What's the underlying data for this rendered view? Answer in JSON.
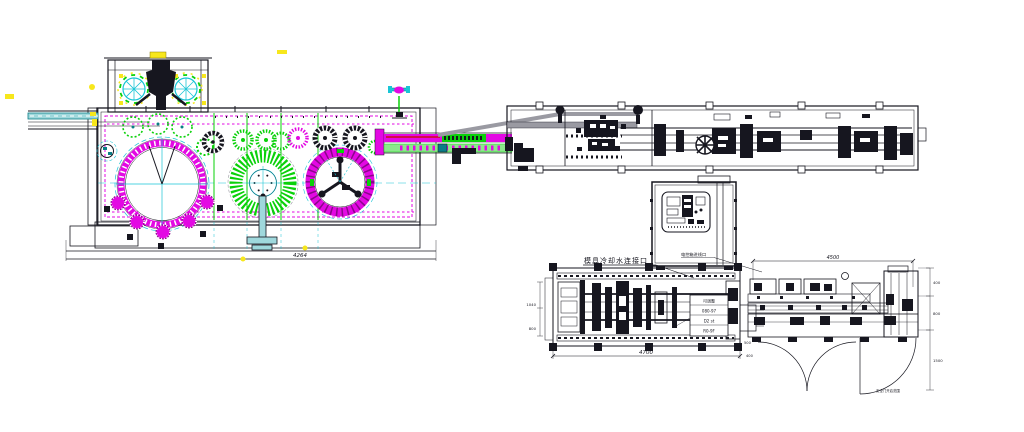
{
  "colors": {
    "background": "#ffffff",
    "ink": "#16161f",
    "magenta": "#e309e3",
    "darkmagenta": "#8a068a",
    "green": "#0ad10a",
    "lightgreen": "#8ce88c",
    "cyan": "#19c5d6",
    "teal": "#0a7d86",
    "lightteal": "#9fd8dc",
    "yellow": "#f7e71c",
    "red": "#cc1111",
    "gray": "#9a9aa2",
    "panel": "#eef6f8"
  },
  "labels": {
    "mold_cooling_note": "模具冷却水连接口",
    "cabinet_note": "电控箱进线口",
    "door_note": "安全门开启范围",
    "panel_box": {
      "row1": "可调整",
      "row2": "080-97",
      "row3": "D2 st",
      "row4": "R0-9F"
    },
    "dims": {
      "filler_width": "4264",
      "clamp_length": "4700",
      "side_width": "4500",
      "left_a": "1040",
      "left_b": "800",
      "gap_a": "500",
      "gap_b": "400",
      "right_a": "400",
      "right_b": "800",
      "right_c": "1500"
    }
  }
}
